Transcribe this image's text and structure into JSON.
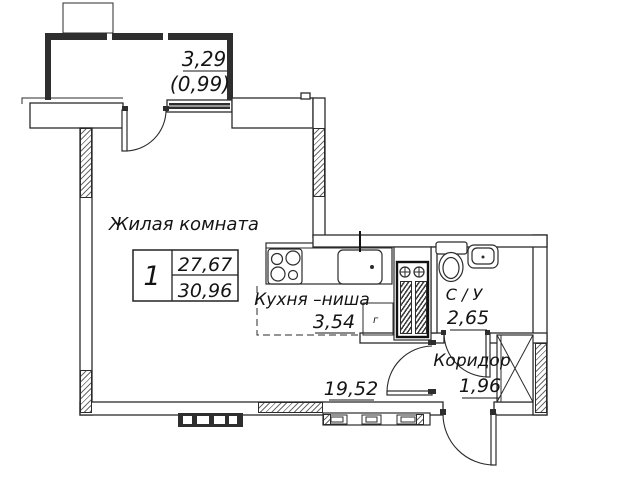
{
  "info_table": {
    "rooms_count": "1",
    "living_area": "27,67",
    "total_area": "30,96"
  },
  "balcony": {
    "area": "3,29",
    "area_with_coefficient": "(0,99)"
  },
  "rooms": {
    "living": {
      "name": "Жилая комната",
      "area": "19,52"
    },
    "kitchen": {
      "name": "Кухня –ниша",
      "area": "3,54"
    },
    "bathroom": {
      "name": "С / У",
      "area": "2,65"
    },
    "corridor": {
      "name": "Коридор",
      "area": "1,96"
    }
  },
  "symbols": {
    "gas_meter": "г"
  },
  "colors": {
    "line": "#2b2b2b",
    "dark_fill": "#2e2e2e",
    "background": "#ffffff",
    "hatch": "#4a4a4a"
  }
}
